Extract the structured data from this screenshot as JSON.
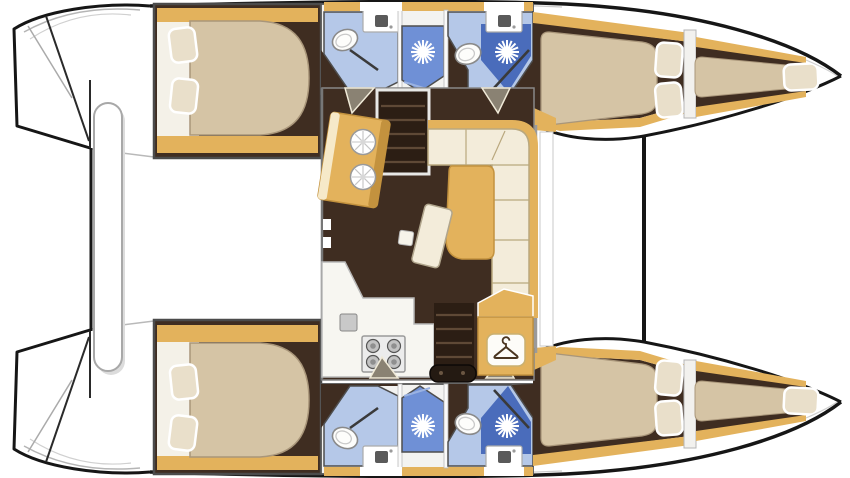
{
  "page": {
    "width": 850,
    "height": 478,
    "background": "#ffffff",
    "title": "Catamaran interior floor plan, top-down view"
  },
  "palette": {
    "floor": "#3f2d21",
    "floor_dark": "#2c1e14",
    "tread": "#5f4936",
    "wood": "#e3b25c",
    "wood_dark": "#c3923e",
    "wood_light": "#efdcae",
    "mattress": "#d5c4a5",
    "mattress_edge": "#a9967a",
    "pillow": "#e9dfca",
    "headboard": "#f4f1e8",
    "cushion": "#f3ecda",
    "cushion_edge": "#b9a87e",
    "bath_floor": "#b5c8e8",
    "shower_mid": "#6f90d6",
    "shower_dark": "#4a6cbb",
    "fixture": "#fdfdfb",
    "counter": "#f7f6f1",
    "steel": "#ececec",
    "burner": "#c2c2c2",
    "outline": "#161616",
    "wall": "#4e4e4e",
    "wall_light": "#9a9a9a",
    "wedge": "#8a8273",
    "icon": "#4a3520",
    "bar": "#241a12"
  },
  "layout": {
    "vessel": "catamaran",
    "view": "deck-plan",
    "hulls": [
      {
        "id": "port",
        "position": "top",
        "rooms": [
          "transom-steps",
          "aft-cabin",
          "bathroom",
          "shower-stall",
          "forward-cabin",
          "forepeak-berth"
        ]
      },
      {
        "id": "starboard",
        "position": "bottom",
        "rooms": [
          "transom-steps",
          "aft-cabin",
          "bathroom",
          "shower-stall",
          "forward-cabin",
          "forepeak-berth"
        ]
      }
    ],
    "bridgedeck": {
      "rooms": [
        "cockpit",
        "saloon",
        "galley",
        "navigation-area",
        "foredeck"
      ]
    },
    "fixtures": [
      "double-bed",
      "pillow",
      "toilet",
      "washbasin",
      "shower-head",
      "shower-screen",
      "galley-sink",
      "stove",
      "sofa",
      "dining-table",
      "coffee-table",
      "companionway-stairs",
      "hanging-locker",
      "crossbeam",
      "dinghy-platform"
    ]
  }
}
